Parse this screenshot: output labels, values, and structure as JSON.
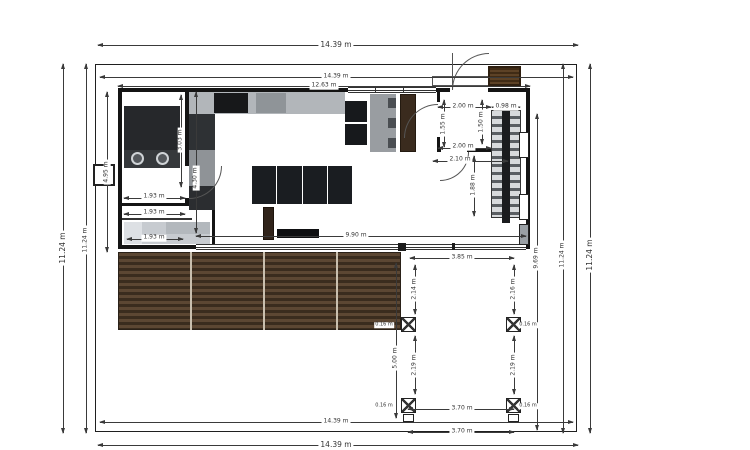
{
  "drawing": {
    "type": "architectural-floor-plan",
    "units": "m",
    "overall_width_label": "14.39 m",
    "overall_height_label": "11.24 m"
  },
  "colors": {
    "dim_line": "#3a3a3a",
    "wall": "#141414",
    "furniture_dark": "#1a1d21",
    "counter_gray": "#b2b6ba",
    "deck_dark": "#3a2c1e",
    "deck_light": "#5c4733",
    "wood_brown": "#3a2b1e",
    "bed_gray": "#c7cbd0"
  },
  "plan": {
    "labels": [
      {
        "name": "dim-top-outer",
        "text": "14.39 m",
        "x": 336,
        "y": 45,
        "rot": 0,
        "cls": "big"
      },
      {
        "name": "dim-top-inner",
        "text": "14.39 m",
        "x": 336,
        "y": 77,
        "rot": 0
      },
      {
        "name": "dim-house-width",
        "text": "12.63 m",
        "x": 324,
        "y": 86,
        "rot": 0
      },
      {
        "name": "dim-bottom-inner",
        "text": "14.39 m",
        "x": 336,
        "y": 422,
        "rot": 0
      },
      {
        "name": "dim-bottom-outer",
        "text": "14.39 m",
        "x": 336,
        "y": 445,
        "rot": 0,
        "cls": "big"
      },
      {
        "name": "dim-left-outer",
        "text": "11.24 m",
        "x": 63,
        "y": 248,
        "rot": 1,
        "cls": "big"
      },
      {
        "name": "dim-left-inner",
        "text": "11.24 m",
        "x": 86,
        "y": 240,
        "rot": 1
      },
      {
        "name": "dim-right-969",
        "text": "9.69 m",
        "x": 537,
        "y": 258,
        "rot": 1
      },
      {
        "name": "dim-right-inner",
        "text": "11.24 m",
        "x": 563,
        "y": 255,
        "rot": 1
      },
      {
        "name": "dim-right-outer",
        "text": "11.24 m",
        "x": 590,
        "y": 255,
        "rot": 1,
        "cls": "big"
      },
      {
        "name": "dim-house-left-height",
        "text": "4.95 m",
        "x": 107,
        "y": 172,
        "rot": 1
      },
      {
        "name": "dim-bath-height",
        "text": "3.03 m",
        "x": 181,
        "y": 140,
        "rot": 1
      },
      {
        "name": "dim-hall-height",
        "text": "4.30 m",
        "x": 196,
        "y": 178,
        "rot": 1
      },
      {
        "name": "dim-room-193-a",
        "text": "1.93 m",
        "x": 154,
        "y": 197,
        "rot": 0
      },
      {
        "name": "dim-room-193-b",
        "text": "1.93 m",
        "x": 154,
        "y": 213,
        "rot": 0
      },
      {
        "name": "dim-room-193-c",
        "text": "1.93 m",
        "x": 154,
        "y": 238,
        "rot": 0
      },
      {
        "name": "dim-entry-top",
        "text": "2.00 m",
        "x": 463,
        "y": 107,
        "rot": 0
      },
      {
        "name": "dim-stair-width",
        "text": "0.98 m",
        "x": 506,
        "y": 107,
        "rot": 0
      },
      {
        "name": "dim-entry-left",
        "text": "1.55 m",
        "x": 444,
        "y": 124,
        "rot": 1
      },
      {
        "name": "dim-entry-door",
        "text": "1.50 m",
        "x": 482,
        "y": 122,
        "rot": 1
      },
      {
        "name": "dim-entry-bottom",
        "text": "2.00 m",
        "x": 463,
        "y": 147,
        "rot": 0
      },
      {
        "name": "dim-entry-hall",
        "text": "2.10 m",
        "x": 460,
        "y": 160,
        "rot": 0
      },
      {
        "name": "dim-stair-run",
        "text": "1.88 m",
        "x": 474,
        "y": 185,
        "rot": 1
      },
      {
        "name": "dim-glass-wall",
        "text": "9.90 m",
        "x": 356,
        "y": 236,
        "rot": 0
      },
      {
        "name": "dim-pergola-width",
        "text": "3.85 m",
        "x": 462,
        "y": 258,
        "rot": 0
      },
      {
        "name": "dim-pergola-left-upper",
        "text": "2.14 m",
        "x": 415,
        "y": 289,
        "rot": 1
      },
      {
        "name": "dim-pergola-right-upper",
        "text": "2.16 m",
        "x": 514,
        "y": 289,
        "rot": 1
      },
      {
        "name": "dim-pergola-left-lower",
        "text": "2.19 m",
        "x": 415,
        "y": 365,
        "rot": 1
      },
      {
        "name": "dim-pergola-right-lower",
        "text": "2.19 m",
        "x": 514,
        "y": 365,
        "rot": 1
      },
      {
        "name": "dim-yard-height",
        "text": "5.00 m",
        "x": 396,
        "y": 358,
        "rot": 1
      },
      {
        "name": "dim-post-a",
        "text": "0.16 m",
        "x": 384,
        "y": 325,
        "rot": 0,
        "cls": "tiny"
      },
      {
        "name": "dim-post-b",
        "text": "0.16 m",
        "x": 528,
        "y": 325,
        "rot": 0,
        "cls": "tiny"
      },
      {
        "name": "dim-post-c",
        "text": "0.16 m",
        "x": 384,
        "y": 406,
        "rot": 0,
        "cls": "tiny"
      },
      {
        "name": "dim-post-d",
        "text": "0.16 m",
        "x": 528,
        "y": 406,
        "rot": 0,
        "cls": "tiny"
      },
      {
        "name": "dim-posts-span-inner",
        "text": "3.70 m",
        "x": 462,
        "y": 409,
        "rot": 0
      },
      {
        "name": "dim-posts-span-outer",
        "text": "3.70 m",
        "x": 462,
        "y": 432,
        "rot": 0
      }
    ],
    "lines": [
      {
        "x": 98,
        "y": 45,
        "w": 480,
        "h": 1
      },
      {
        "x": 100,
        "y": 77,
        "w": 473,
        "h": 1
      },
      {
        "x": 118,
        "y": 86,
        "w": 412,
        "h": 1
      },
      {
        "x": 100,
        "y": 422,
        "w": 473,
        "h": 1
      },
      {
        "x": 98,
        "y": 445,
        "w": 480,
        "h": 1
      },
      {
        "x": 63,
        "y": 64,
        "w": 1,
        "h": 369
      },
      {
        "x": 86,
        "y": 64,
        "w": 1,
        "h": 369
      },
      {
        "x": 537,
        "y": 114,
        "w": 1,
        "h": 316
      },
      {
        "x": 563,
        "y": 64,
        "w": 1,
        "h": 369
      },
      {
        "x": 590,
        "y": 64,
        "w": 1,
        "h": 369
      },
      {
        "x": 107,
        "y": 92,
        "w": 1,
        "h": 160
      },
      {
        "x": 181,
        "y": 95,
        "w": 1,
        "h": 92
      },
      {
        "x": 196,
        "y": 92,
        "w": 1,
        "h": 141
      },
      {
        "x": 124,
        "y": 198,
        "w": 61,
        "h": 1
      },
      {
        "x": 124,
        "y": 214,
        "w": 61,
        "h": 1
      },
      {
        "x": 127,
        "y": 239,
        "w": 56,
        "h": 1
      },
      {
        "x": 438,
        "y": 107,
        "w": 53,
        "h": 1
      },
      {
        "x": 492,
        "y": 107,
        "w": 28,
        "h": 1
      },
      {
        "x": 444,
        "y": 100,
        "w": 1,
        "h": 47
      },
      {
        "x": 482,
        "y": 100,
        "w": 1,
        "h": 44
      },
      {
        "x": 438,
        "y": 148,
        "w": 53,
        "h": 1
      },
      {
        "x": 433,
        "y": 161,
        "w": 75,
        "h": 1
      },
      {
        "x": 474,
        "y": 156,
        "w": 1,
        "h": 60
      },
      {
        "x": 196,
        "y": 236,
        "w": 330,
        "h": 1
      },
      {
        "x": 410,
        "y": 258,
        "w": 104,
        "h": 1
      },
      {
        "x": 415,
        "y": 265,
        "w": 1,
        "h": 49
      },
      {
        "x": 514,
        "y": 265,
        "w": 1,
        "h": 49
      },
      {
        "x": 415,
        "y": 336,
        "w": 1,
        "h": 58
      },
      {
        "x": 514,
        "y": 336,
        "w": 1,
        "h": 58
      },
      {
        "x": 396,
        "y": 263,
        "w": 1,
        "h": 155
      },
      {
        "x": 408,
        "y": 409,
        "w": 106,
        "h": 1
      },
      {
        "x": 408,
        "y": 432,
        "w": 106,
        "h": 1
      }
    ]
  }
}
